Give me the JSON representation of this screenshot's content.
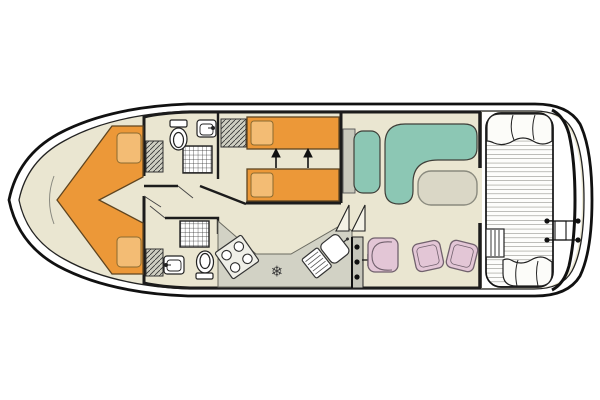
{
  "palette": {
    "hull_outline": "#111111",
    "inner_line": "#222222",
    "wall_black": "#1c1c1c",
    "floor_cream": "#EAE6D1",
    "deck_white": "#FDFDFB",
    "bed_orange": "#EC9838",
    "pillow_orange": "#F3BC74",
    "bed_edge": "#5f4520",
    "sofa_teal": "#8CC7B4",
    "chair_pink": "#E3C6D6",
    "chair_edge": "#71616d",
    "counter_gray": "#D2D2C5",
    "cabinet_gray": "#C9C9BC",
    "table_beige": "#DAD7C6",
    "wardrobe_gray": "#CFCFC2",
    "fixture_white": "#FFFFFF",
    "stove_white": "#EFEFE8",
    "plank_line": "#70706a",
    "icon_dark": "#3a3a3a"
  },
  "icons": {
    "fridge_snowflake": "❄"
  }
}
